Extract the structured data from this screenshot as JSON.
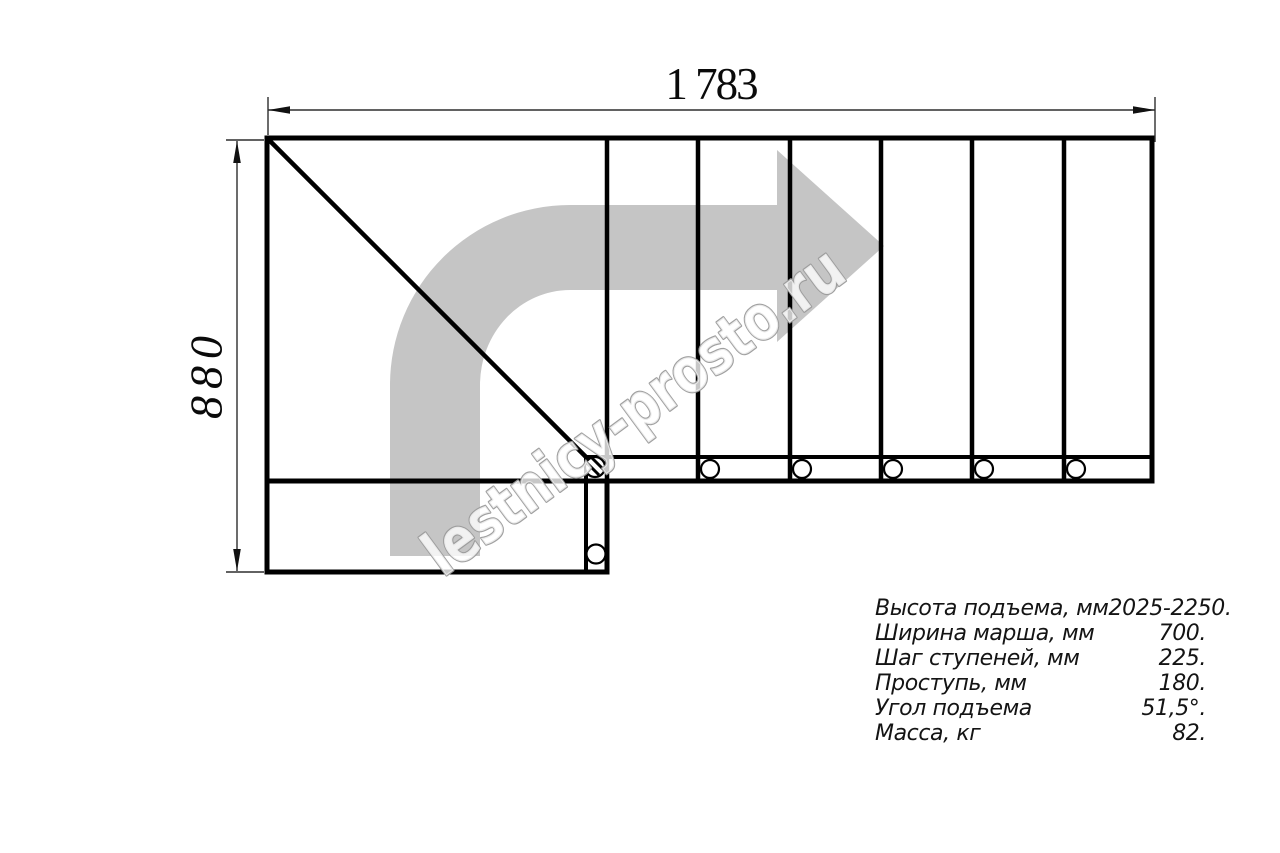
{
  "drawing": {
    "dimensions": {
      "width_label": "1 783",
      "height_label": "880"
    },
    "watermark": "lestnicy-prosto.ru",
    "colors": {
      "line": "#000000",
      "arrow": "#c5c5c5",
      "dimension_line": "#2e2e2e",
      "watermark_stroke": "#9b9b9b",
      "watermark_fill": "#ffffff"
    }
  },
  "specs": {
    "rows": [
      {
        "label": "Высота подъема, мм",
        "value": "2025-2250."
      },
      {
        "label": "Ширина марша, мм",
        "value": "700."
      },
      {
        "label": "Шаг ступеней, мм",
        "value": "225."
      },
      {
        "label": "Проступь, мм",
        "value": "180."
      },
      {
        "label": "Угол подъема",
        "value": "51,5°."
      },
      {
        "label": "Масса, кг",
        "value": "82."
      }
    ]
  }
}
